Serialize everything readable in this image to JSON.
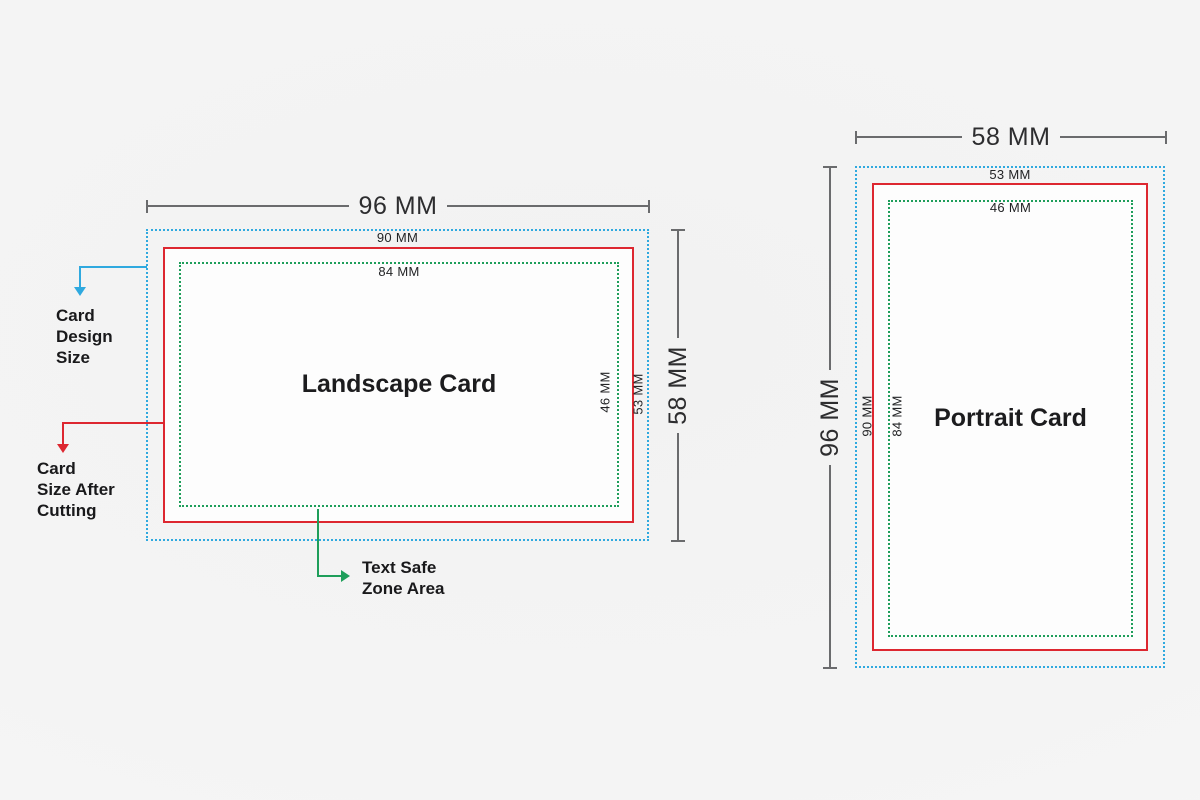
{
  "colors": {
    "design_blue": "#2FA9DF",
    "cut_red": "#DD2730",
    "safe_green": "#1E9E5A",
    "dim_line": "#6a6b6d",
    "dim_text": "#2d2d2f",
    "card_fill": "#fdfdfd"
  },
  "landscape": {
    "title": "Landscape Card",
    "design_width": "96 MM",
    "design_height": "58 MM",
    "cut_width": "90 MM",
    "cut_height": "53 MM",
    "safe_width": "84 MM",
    "safe_height": "46 MM"
  },
  "portrait": {
    "title": "Portrait Card",
    "design_width": "58 MM",
    "design_height": "96 MM",
    "cut_width": "53 MM",
    "cut_height": "90 MM",
    "safe_width": "46 MM",
    "safe_height": "84 MM"
  },
  "annotations": {
    "design": {
      "lines": [
        "Card",
        "Design",
        "Size"
      ]
    },
    "cut": {
      "lines": [
        "Card",
        "Size After",
        "Cutting"
      ]
    },
    "safe": {
      "lines": [
        "Text Safe",
        "Zone Area"
      ]
    }
  }
}
